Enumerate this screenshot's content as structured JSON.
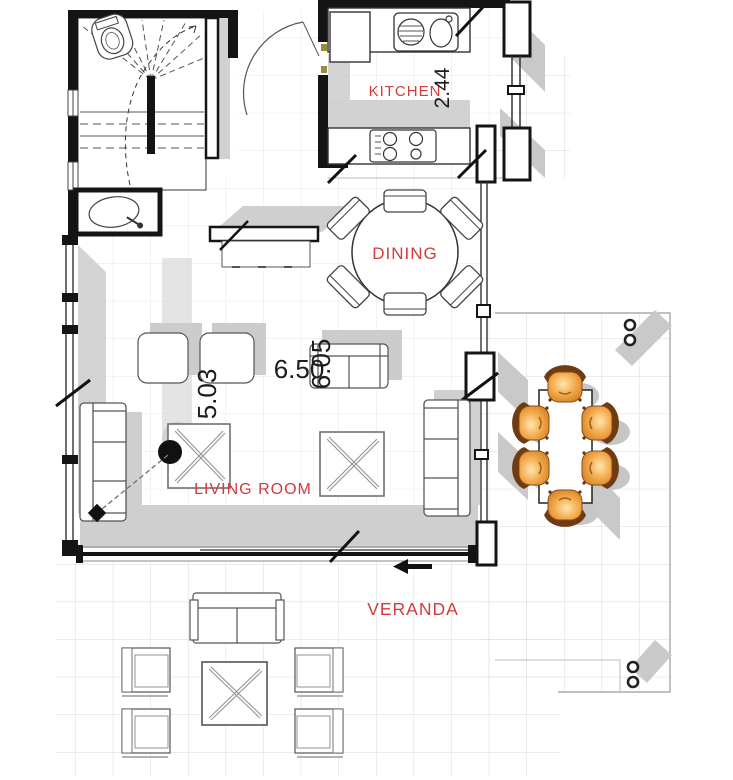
{
  "title": "Ground floor plan",
  "colors": {
    "room_label": "#d43b3b",
    "dimension_text": "#1c1c1c",
    "wall": "#141414",
    "shadow": "#c9c9c9",
    "grid": "#e4e4e4",
    "chair_wood": "#f0a84a",
    "chair_trim": "#6e3b13"
  },
  "rooms": {
    "kitchen": {
      "label": "KITCHEN"
    },
    "dining": {
      "label": "DINING"
    },
    "living": {
      "label": "LIVING ROOM"
    },
    "veranda": {
      "label": "VERANDA"
    }
  },
  "dimensions": {
    "kitchen_depth": "2.44",
    "plan_width": "6.50",
    "living_depth": "6.05",
    "living_width": "5.03"
  }
}
